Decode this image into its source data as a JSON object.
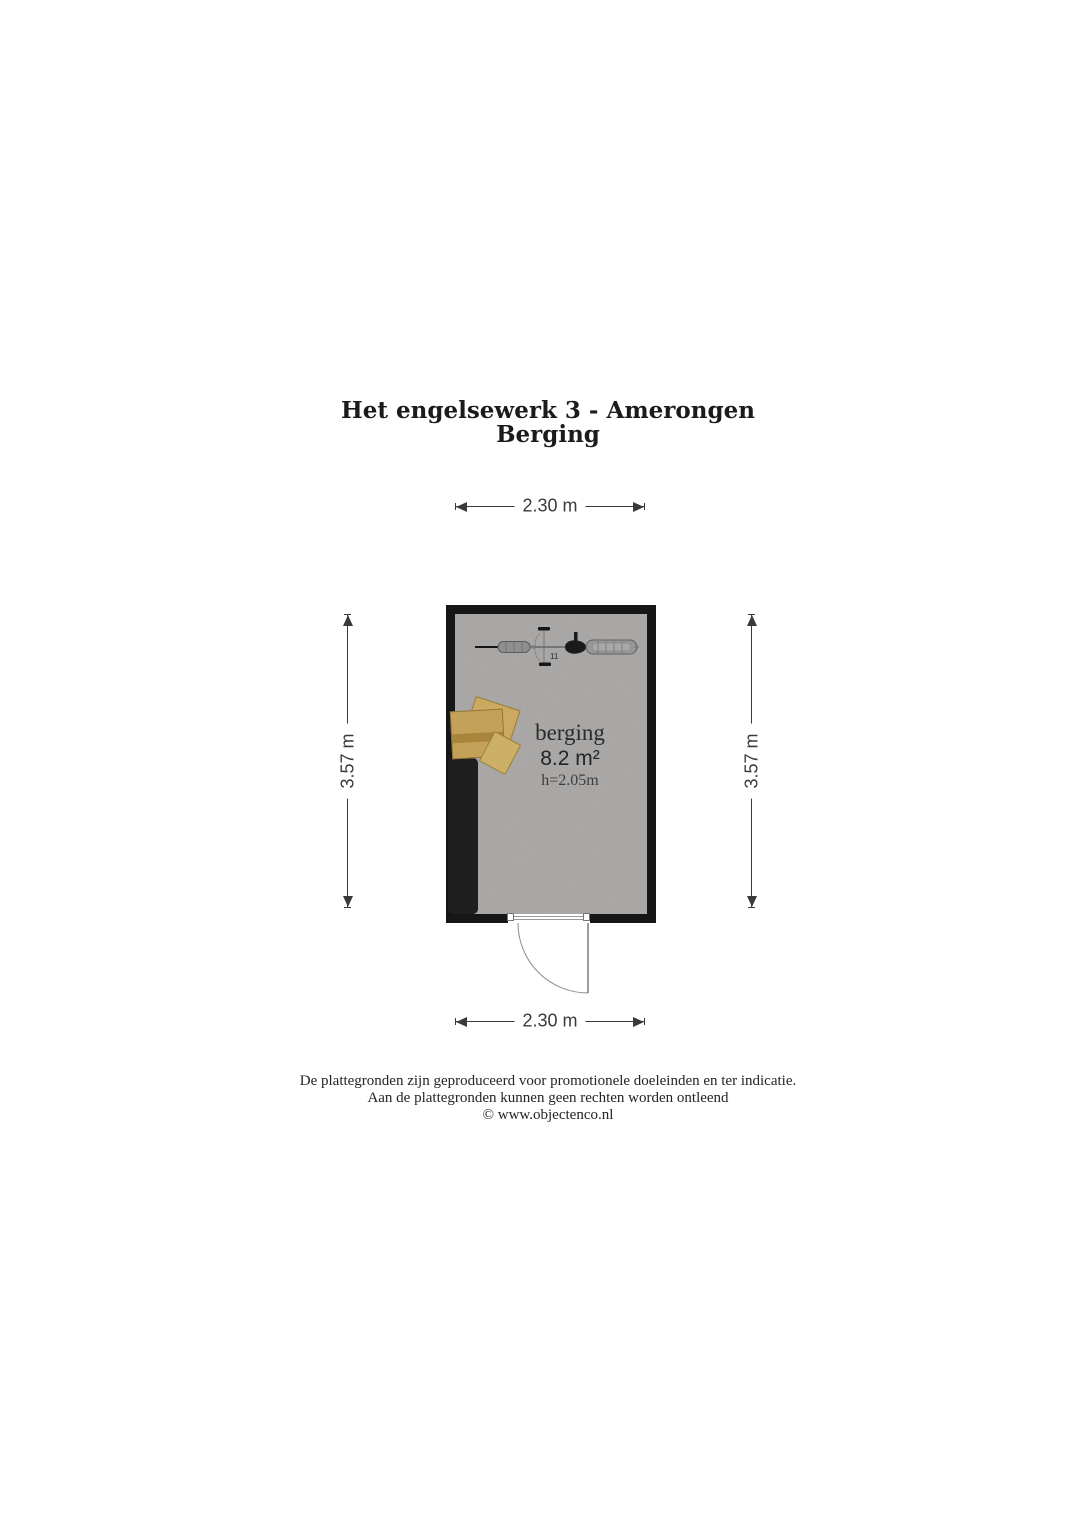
{
  "title": {
    "line1": "Het engelsewerk 3 - Amerongen",
    "line2": "Berging"
  },
  "dimensions": {
    "top": "2.30 m",
    "bottom": "2.30 m",
    "left": "3.57 m",
    "right": "3.57 m"
  },
  "room": {
    "name": "berging",
    "area": "8.2 m²",
    "ceiling_height": "h=2.05m",
    "bike_marking": "11"
  },
  "icons": {
    "bicycle": "bicycle-top-view-icon",
    "boxes": "cardboard-boxes-icon",
    "storage_unit": "shelving-unit-shape",
    "door": "door-swing-arc"
  },
  "footer": {
    "line1": "De plattegronden zijn geproduceerd voor promotionele doeleinden en ter indicatie.",
    "line2": "Aan de plattegronden kunnen geen rechten worden ontleend",
    "line3": "© www.objectenco.nl"
  },
  "colors": {
    "wall": "#161616",
    "floor": "#a8a6a4",
    "dim": "#3a3a3a",
    "text": "#1d1d1d",
    "box": "#c4a158",
    "box-tape": "#a8853b",
    "storage": "#1f1f1f"
  }
}
